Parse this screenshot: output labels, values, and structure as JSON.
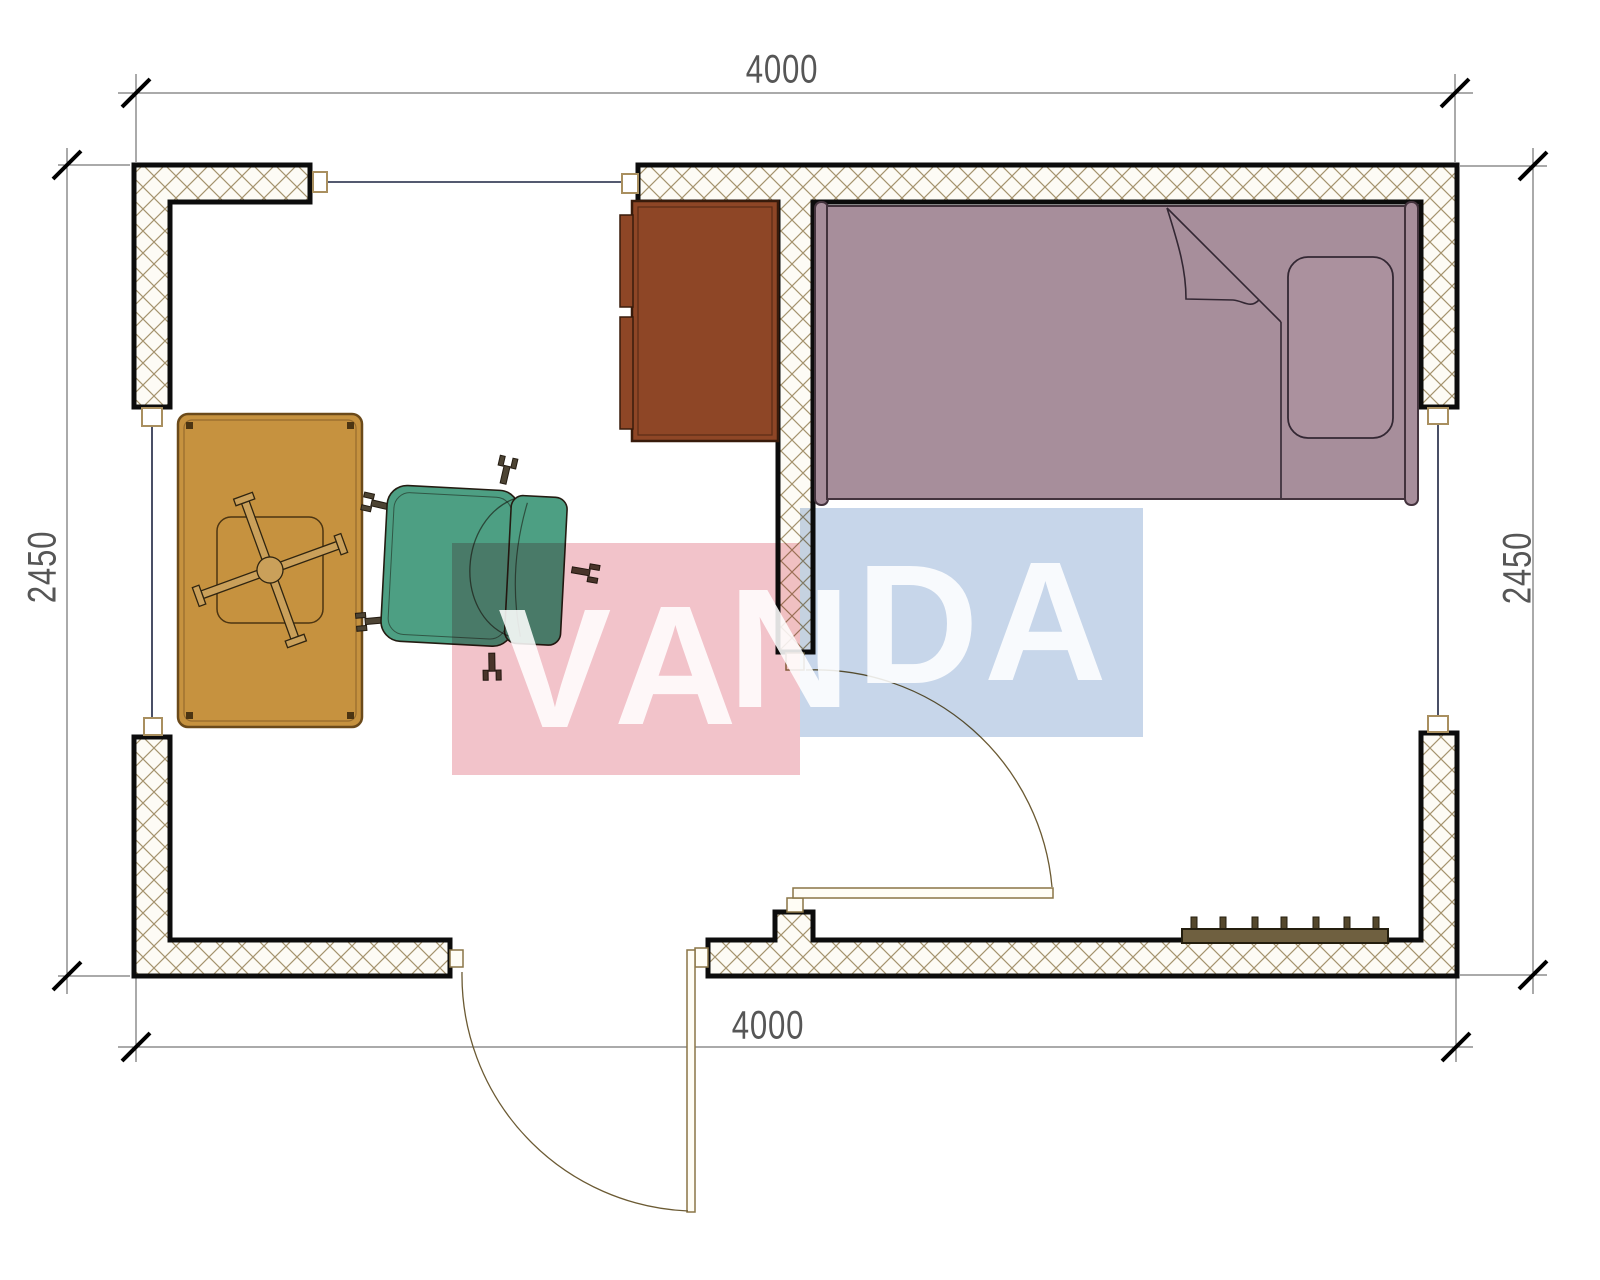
{
  "drawing": {
    "type": "floor-plan",
    "room_outer_width_mm": "4000",
    "room_outer_height_mm": "2450"
  },
  "dimensions": {
    "top": "4000",
    "bottom": "4000",
    "left": "2450",
    "right": "2450"
  },
  "watermark": {
    "text": "VANDA",
    "letters": [
      "V",
      "A",
      "N",
      "D",
      "A"
    ],
    "pink_block_color": "#f2c3ca",
    "blue_block_color": "#c7d6ea",
    "letter_color": "rgba(255,255,255,0.87)"
  },
  "colors": {
    "wall_outline": "#0c0c0c",
    "wall_hatch_line": "#a5936e",
    "wall_fill": "#fdfbf5",
    "window_line": "#1c2340",
    "window_frame": "#a98f5f",
    "door_arc": "#6b5a33",
    "bed_fill": "#a78e9b",
    "bed_line": "#43333d",
    "desk_fill": "#8e4626",
    "table_fill": "#c6923f",
    "chair_fill": "#4d9f83",
    "radiator_fill": "#6f6040",
    "dimension_line": "#555555",
    "dimension_text": "#3f3f3f"
  }
}
